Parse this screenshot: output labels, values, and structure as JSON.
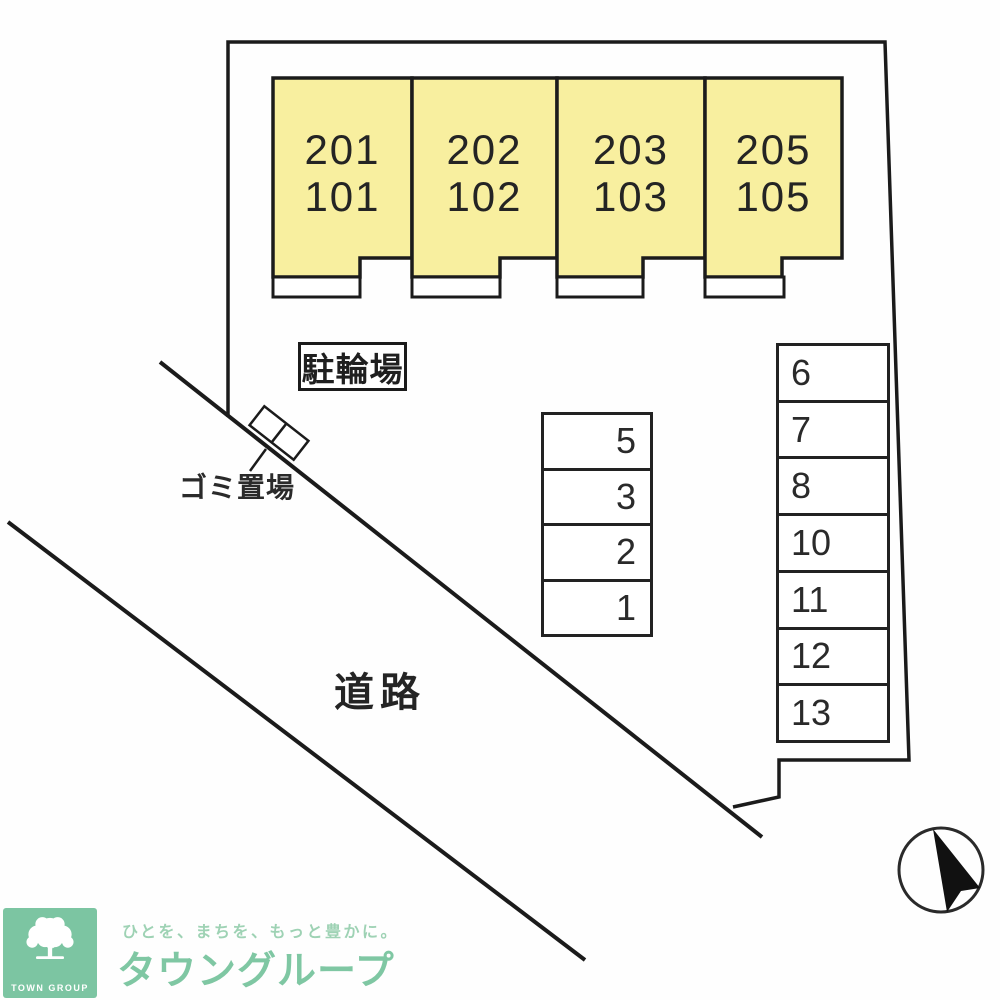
{
  "plan": {
    "buildings": [
      {
        "upper": "201",
        "lower": "101"
      },
      {
        "upper": "202",
        "lower": "102"
      },
      {
        "upper": "203",
        "lower": "103"
      },
      {
        "upper": "205",
        "lower": "105"
      }
    ],
    "labels": {
      "bicycle_parking": "駐輪場",
      "garbage_area": "ゴミ置場",
      "road": "道路"
    },
    "parking_middle": {
      "spaces": [
        "5",
        "3",
        "2",
        "1"
      ]
    },
    "parking_right": {
      "spaces": [
        "6",
        "7",
        "8",
        "10",
        "11",
        "12",
        "13"
      ]
    }
  },
  "footer": {
    "logo_text": "TOWN GROUP",
    "tagline": "ひとを、まちを、もっと豊かに。",
    "brand": "タウングループ"
  },
  "colors": {
    "building_fill": "#f8ef9f",
    "line": "#1b1b1b",
    "brand_green": "#7cc5a2",
    "tagline_green": "#9ed2b4"
  }
}
